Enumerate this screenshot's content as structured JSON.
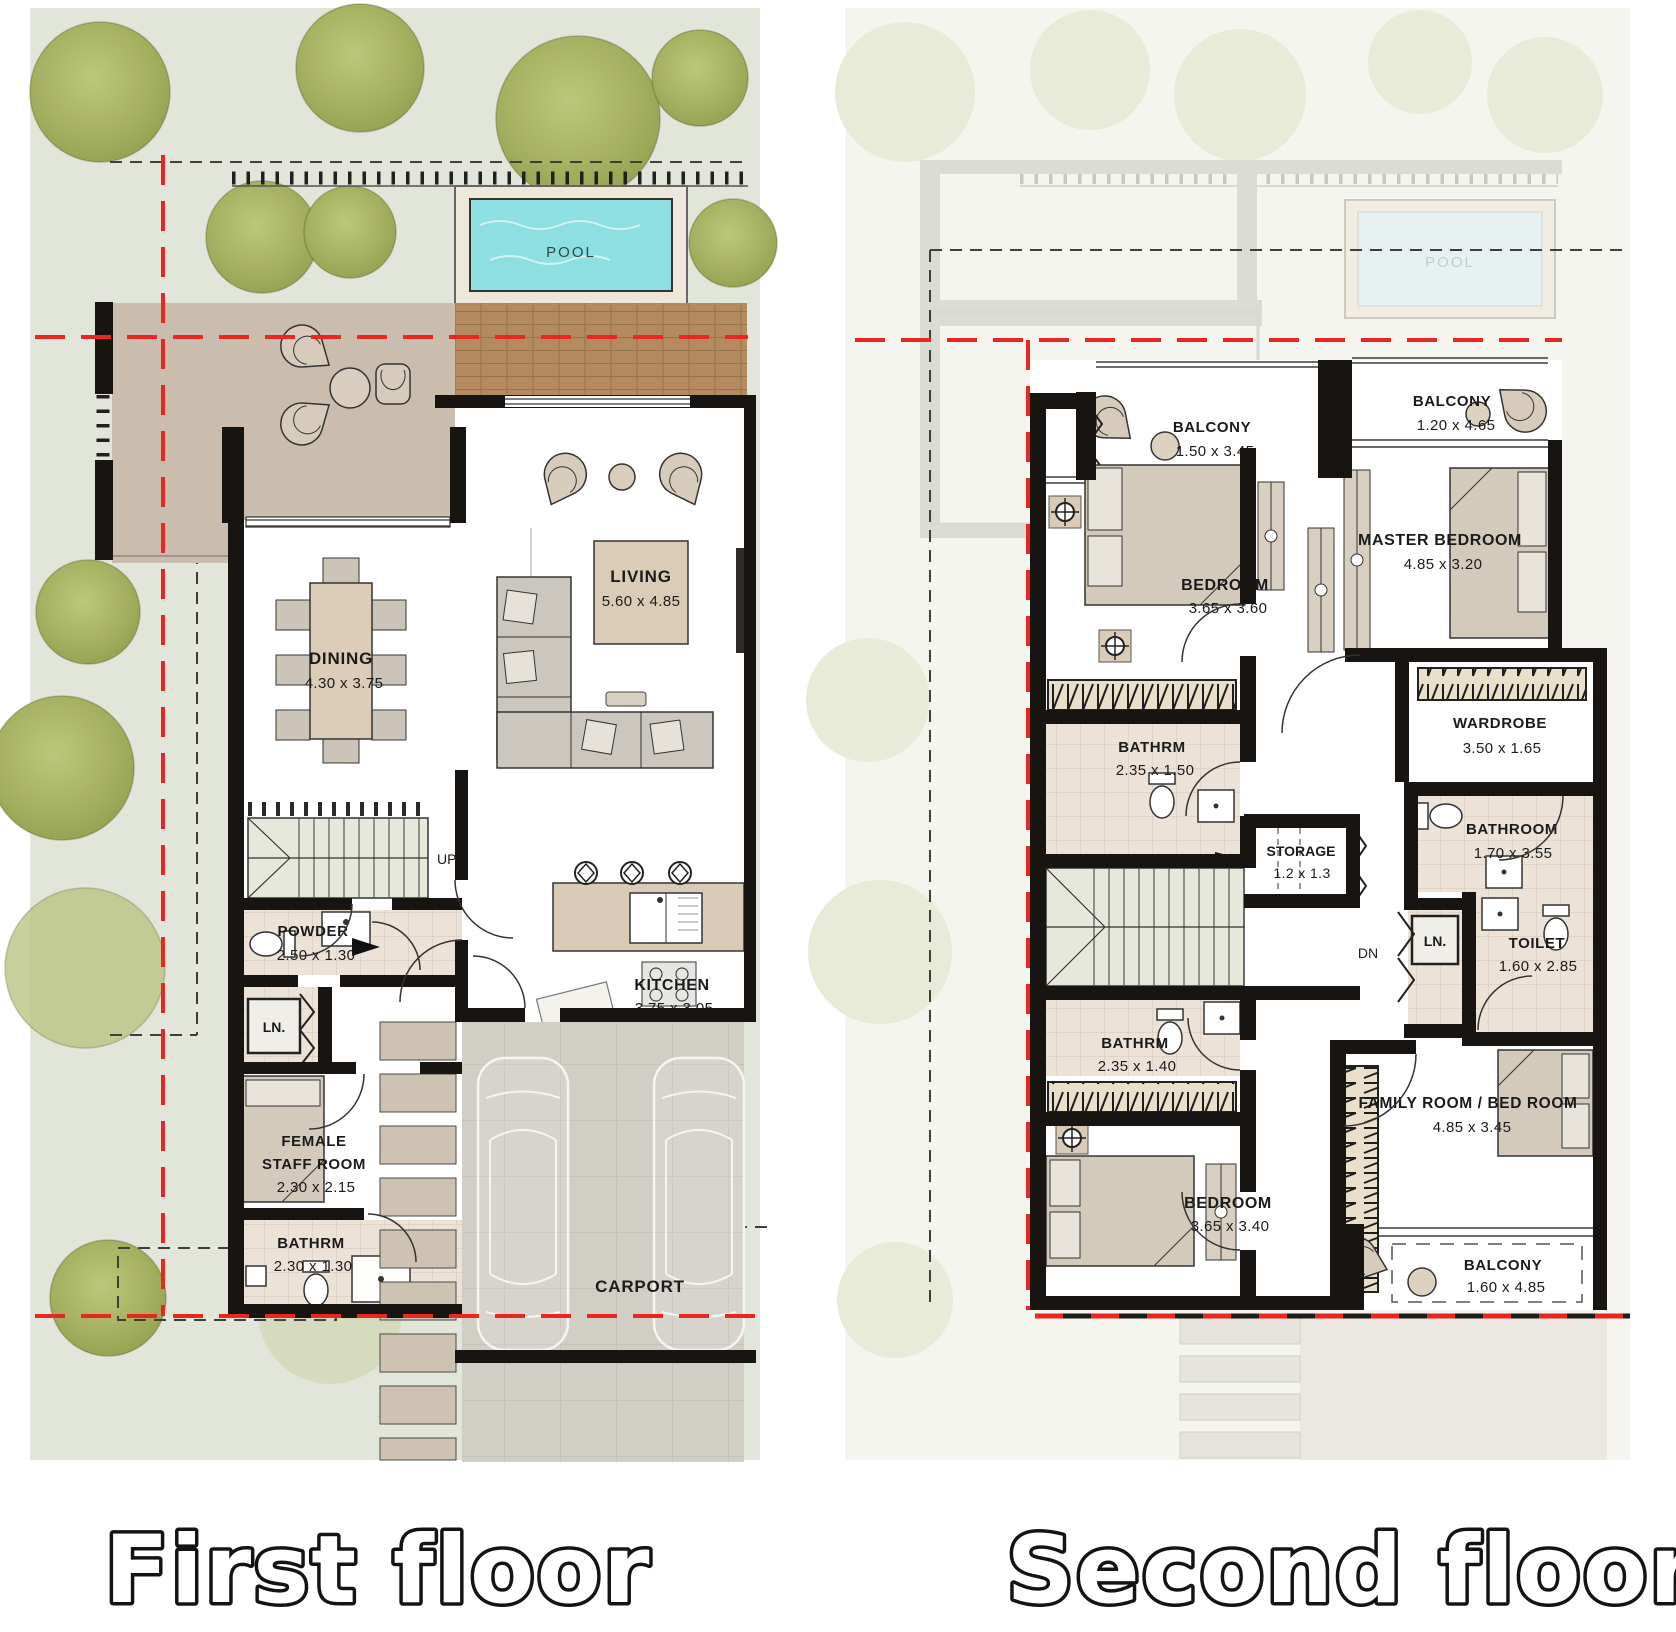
{
  "titles": {
    "first": "First floor",
    "second": "Second floor"
  },
  "ff": {
    "pool": "POOL",
    "up": "UP",
    "dining": {
      "name": "DINING",
      "dim": "4.30 x 3.75"
    },
    "living": {
      "name": "LIVING",
      "dim": "5.60 x 4.85"
    },
    "powder": {
      "name": "POWDER",
      "dim": "2.50 x 1.30"
    },
    "linen": "LN.",
    "staff": {
      "l1": "FEMALE",
      "l2": "STAFF ROOM",
      "dim": "2.30 x 2.15"
    },
    "bath": {
      "name": "BATHRM",
      "dim": "2.30 x 1.30"
    },
    "kitchen": {
      "name": "KITCHEN",
      "dim": "3.75 x 3.05"
    },
    "carport": "CARPORT"
  },
  "sf": {
    "pool": "POOL",
    "dn": "DN",
    "linen": "LN.",
    "balcony1": {
      "name": "BALCONY",
      "dim": "1.50 x 3.45"
    },
    "balcony2": {
      "name": "BALCONY",
      "dim": "1.20 x 4.65"
    },
    "bedroom1": {
      "name": "BEDROOM",
      "dim": "3.65 x 3.60"
    },
    "master": {
      "name": "MASTER BEDROOM",
      "dim": "4.85 x 3.20"
    },
    "bath1": {
      "name": "BATHRM",
      "dim": "2.35 x 1.50"
    },
    "wardrobe": {
      "name": "WARDROBE",
      "dim": "3.50 x 1.65"
    },
    "storage": {
      "name": "STORAGE",
      "dim": "1.2 x 1.3"
    },
    "bathroom": {
      "name": "BATHROOM",
      "dim": "1.70 x 3.55"
    },
    "toilet": {
      "name": "TOILET",
      "dim": "1.60 x 2.85"
    },
    "bath2": {
      "name": "BATHRM",
      "dim": "2.35 x 1.40"
    },
    "bedroom2": {
      "name": "BEDROOM",
      "dim": "3.65 x 3.40"
    },
    "family": {
      "name": "FAMILY ROOM / BED ROOM",
      "dim": "4.85 x 3.45"
    },
    "balcony3": {
      "name": "BALCONY",
      "dim": "1.60 x 4.85"
    }
  },
  "colors": {
    "ground": "#e2e5d9",
    "tree": "#a3b15c",
    "pool_water": "#8edfe2",
    "terrace": "#cbbdae",
    "deck": "#b48b60",
    "wall": "#171411",
    "tile": "#ede2d8",
    "furniture_tan": "#d9cbb9",
    "stairs": "#e7e8dc",
    "paving": "#d1cec6",
    "red_line": "#ea2620"
  }
}
